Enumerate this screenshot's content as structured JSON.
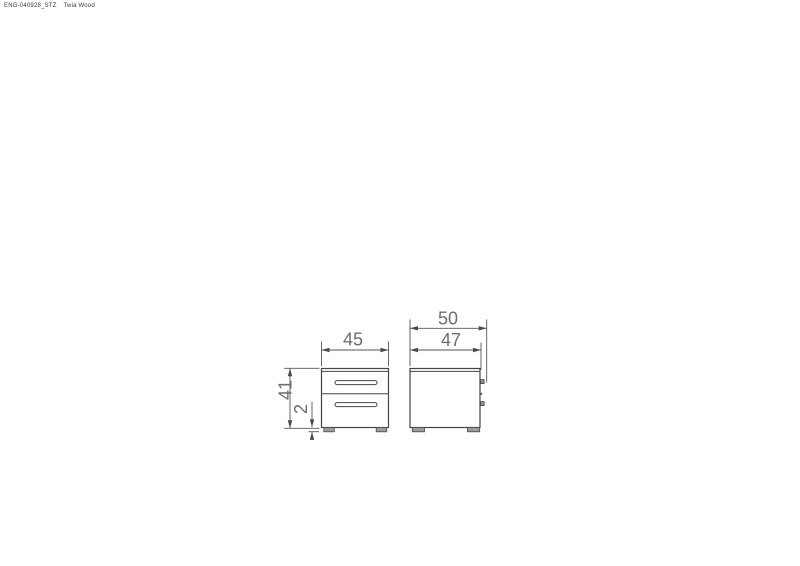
{
  "header": {
    "document_code": "ENG-040928_STZ",
    "product_name": "Twia Wood"
  },
  "drawing": {
    "front_view": {
      "width_dim_label": "45",
      "height_dim_label": "41",
      "foot_height_dim_label": "2"
    },
    "side_view": {
      "overall_depth_dim_label": "50",
      "body_depth_dim_label": "47"
    }
  },
  "colors": {
    "line": "#454545",
    "dim_text": "#6e6e6e",
    "background": "#ffffff"
  }
}
